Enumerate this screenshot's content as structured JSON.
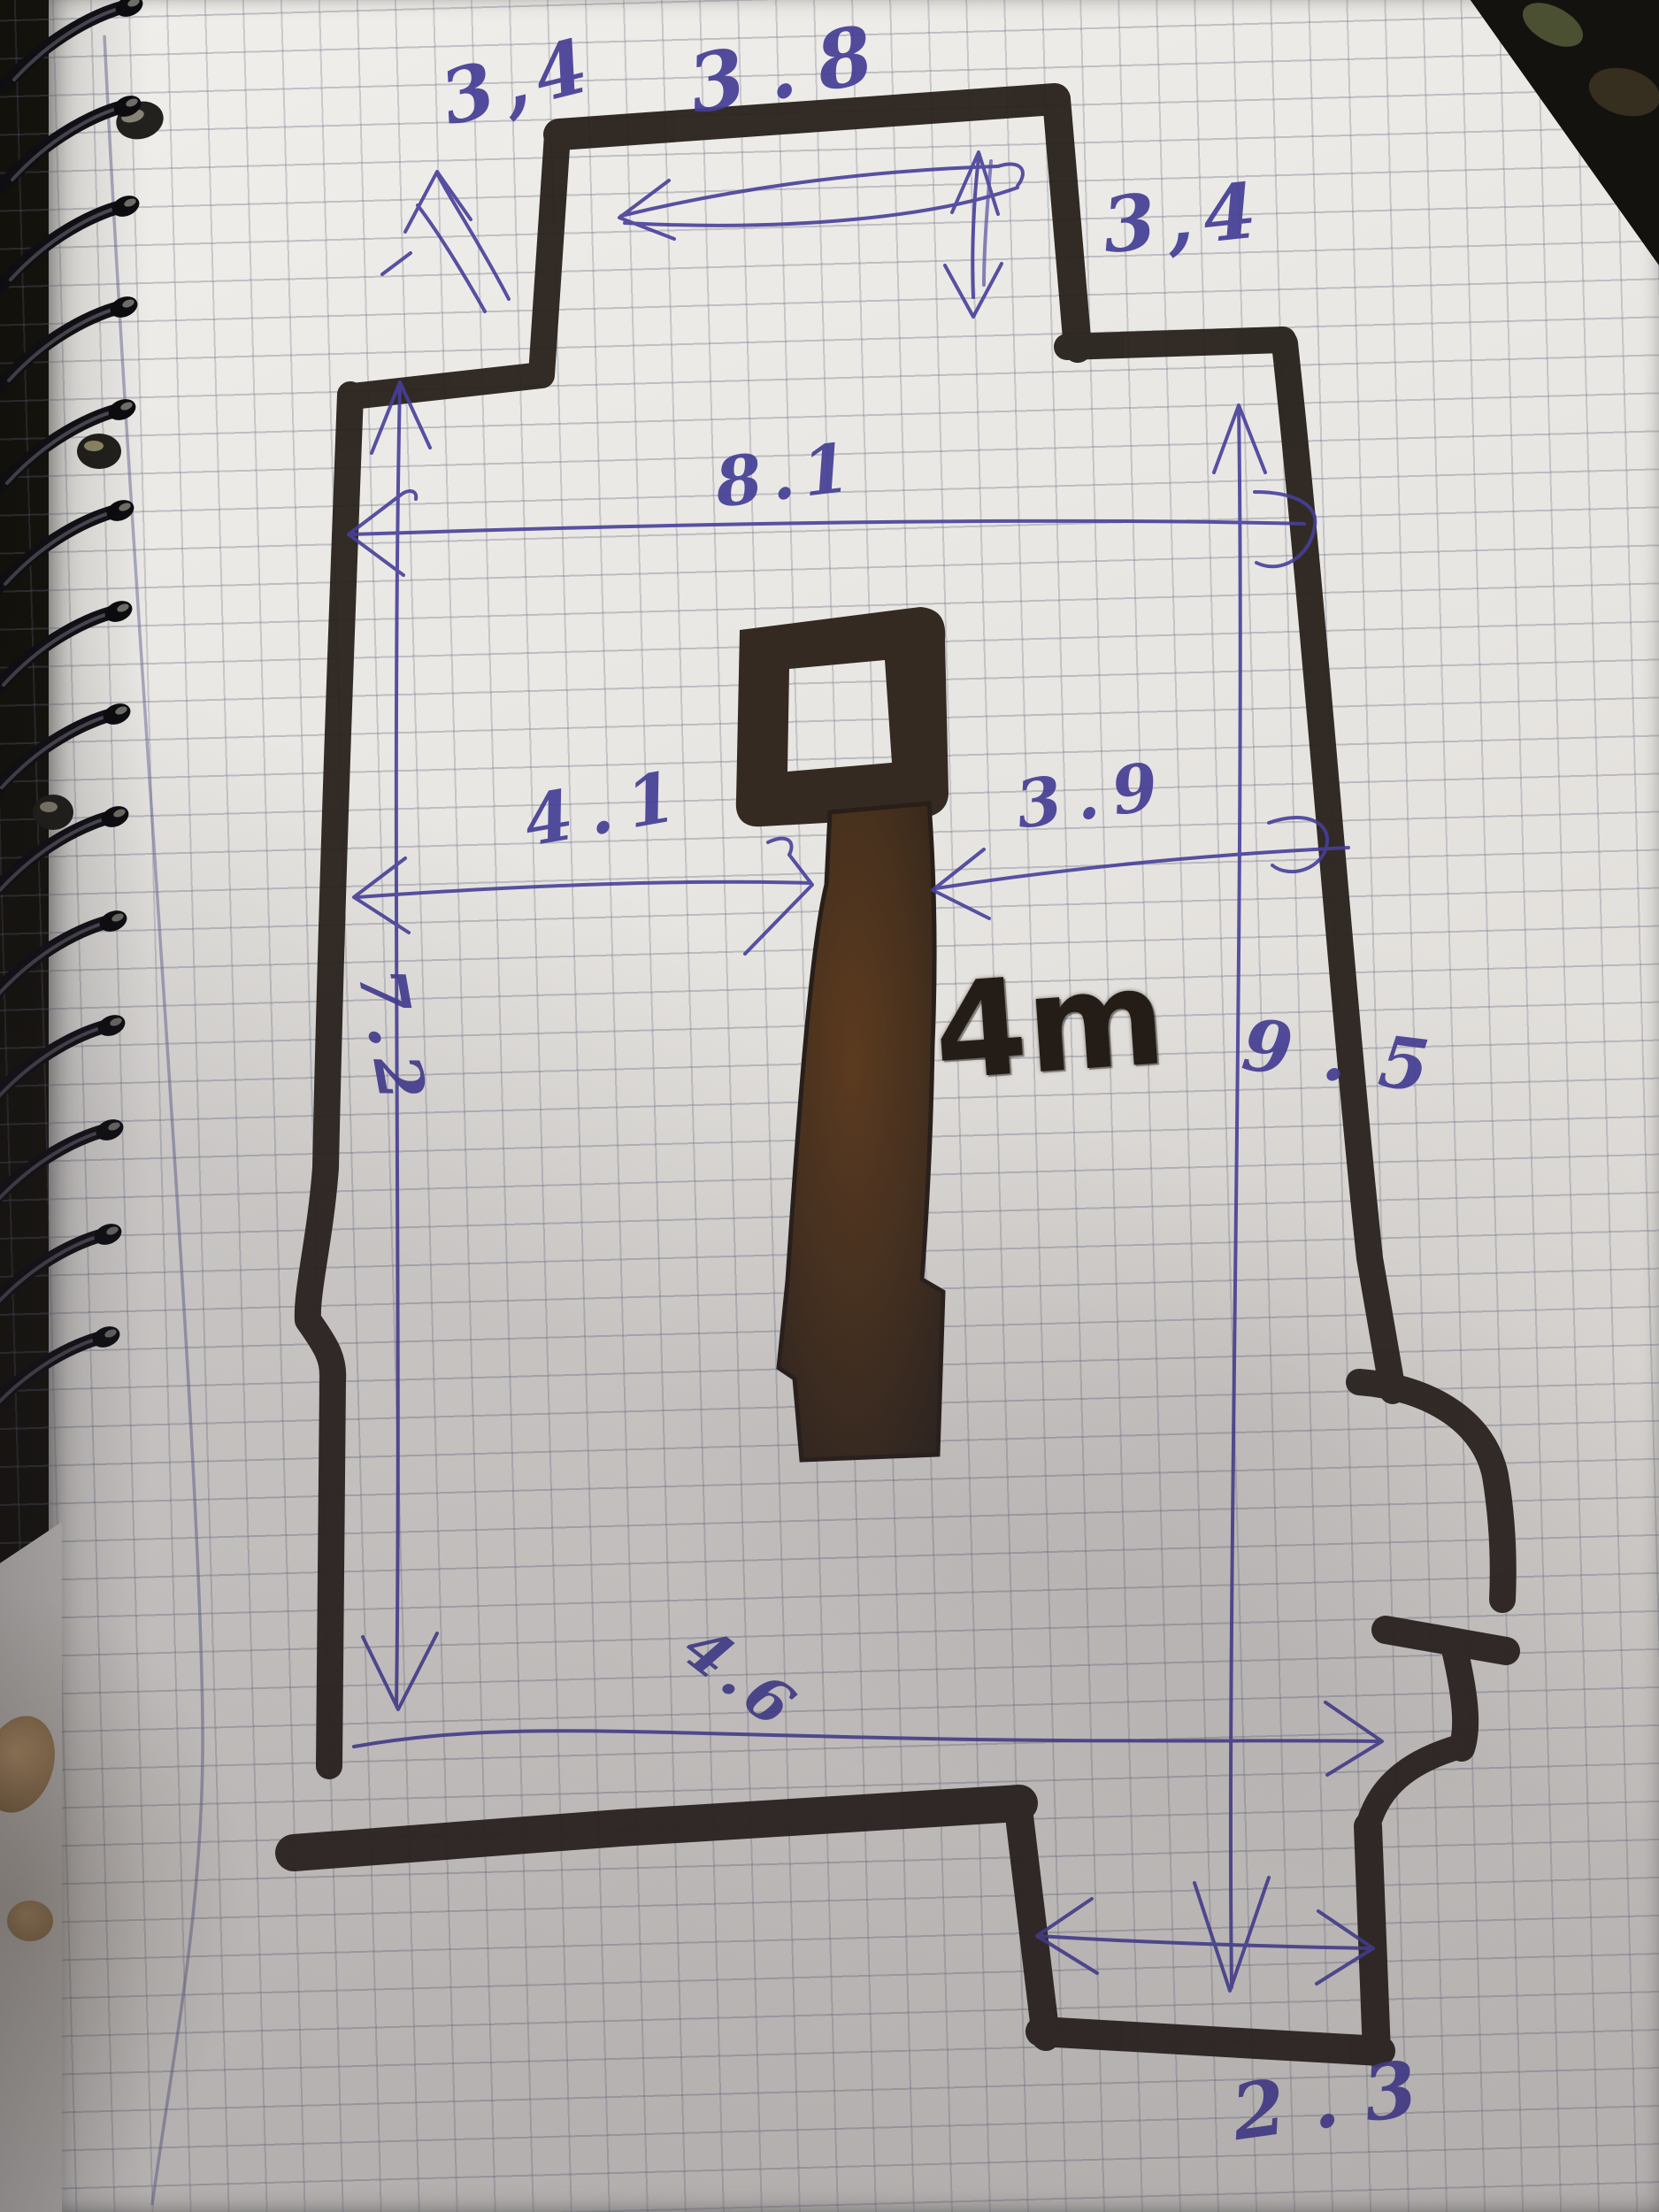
{
  "sketch": {
    "type": "hand-drawn floor plan on squared notebook paper",
    "labels": {
      "top_left_height": "3,4",
      "top_width": "3.8",
      "top_right_height": "3,4",
      "upper_width": "8.1",
      "left_to_object": "4.1",
      "object_to_right": "3.9",
      "left_height": "7.2",
      "right_height": "9.5",
      "object_note": "4m",
      "bottom_width": "4.6",
      "alcove_width": "2.3"
    },
    "colors": {
      "ink_blue": "#453e95",
      "marker_black": "#2b241f",
      "marker_brown": "#4a3322",
      "paper": "#e8e6e2"
    }
  }
}
